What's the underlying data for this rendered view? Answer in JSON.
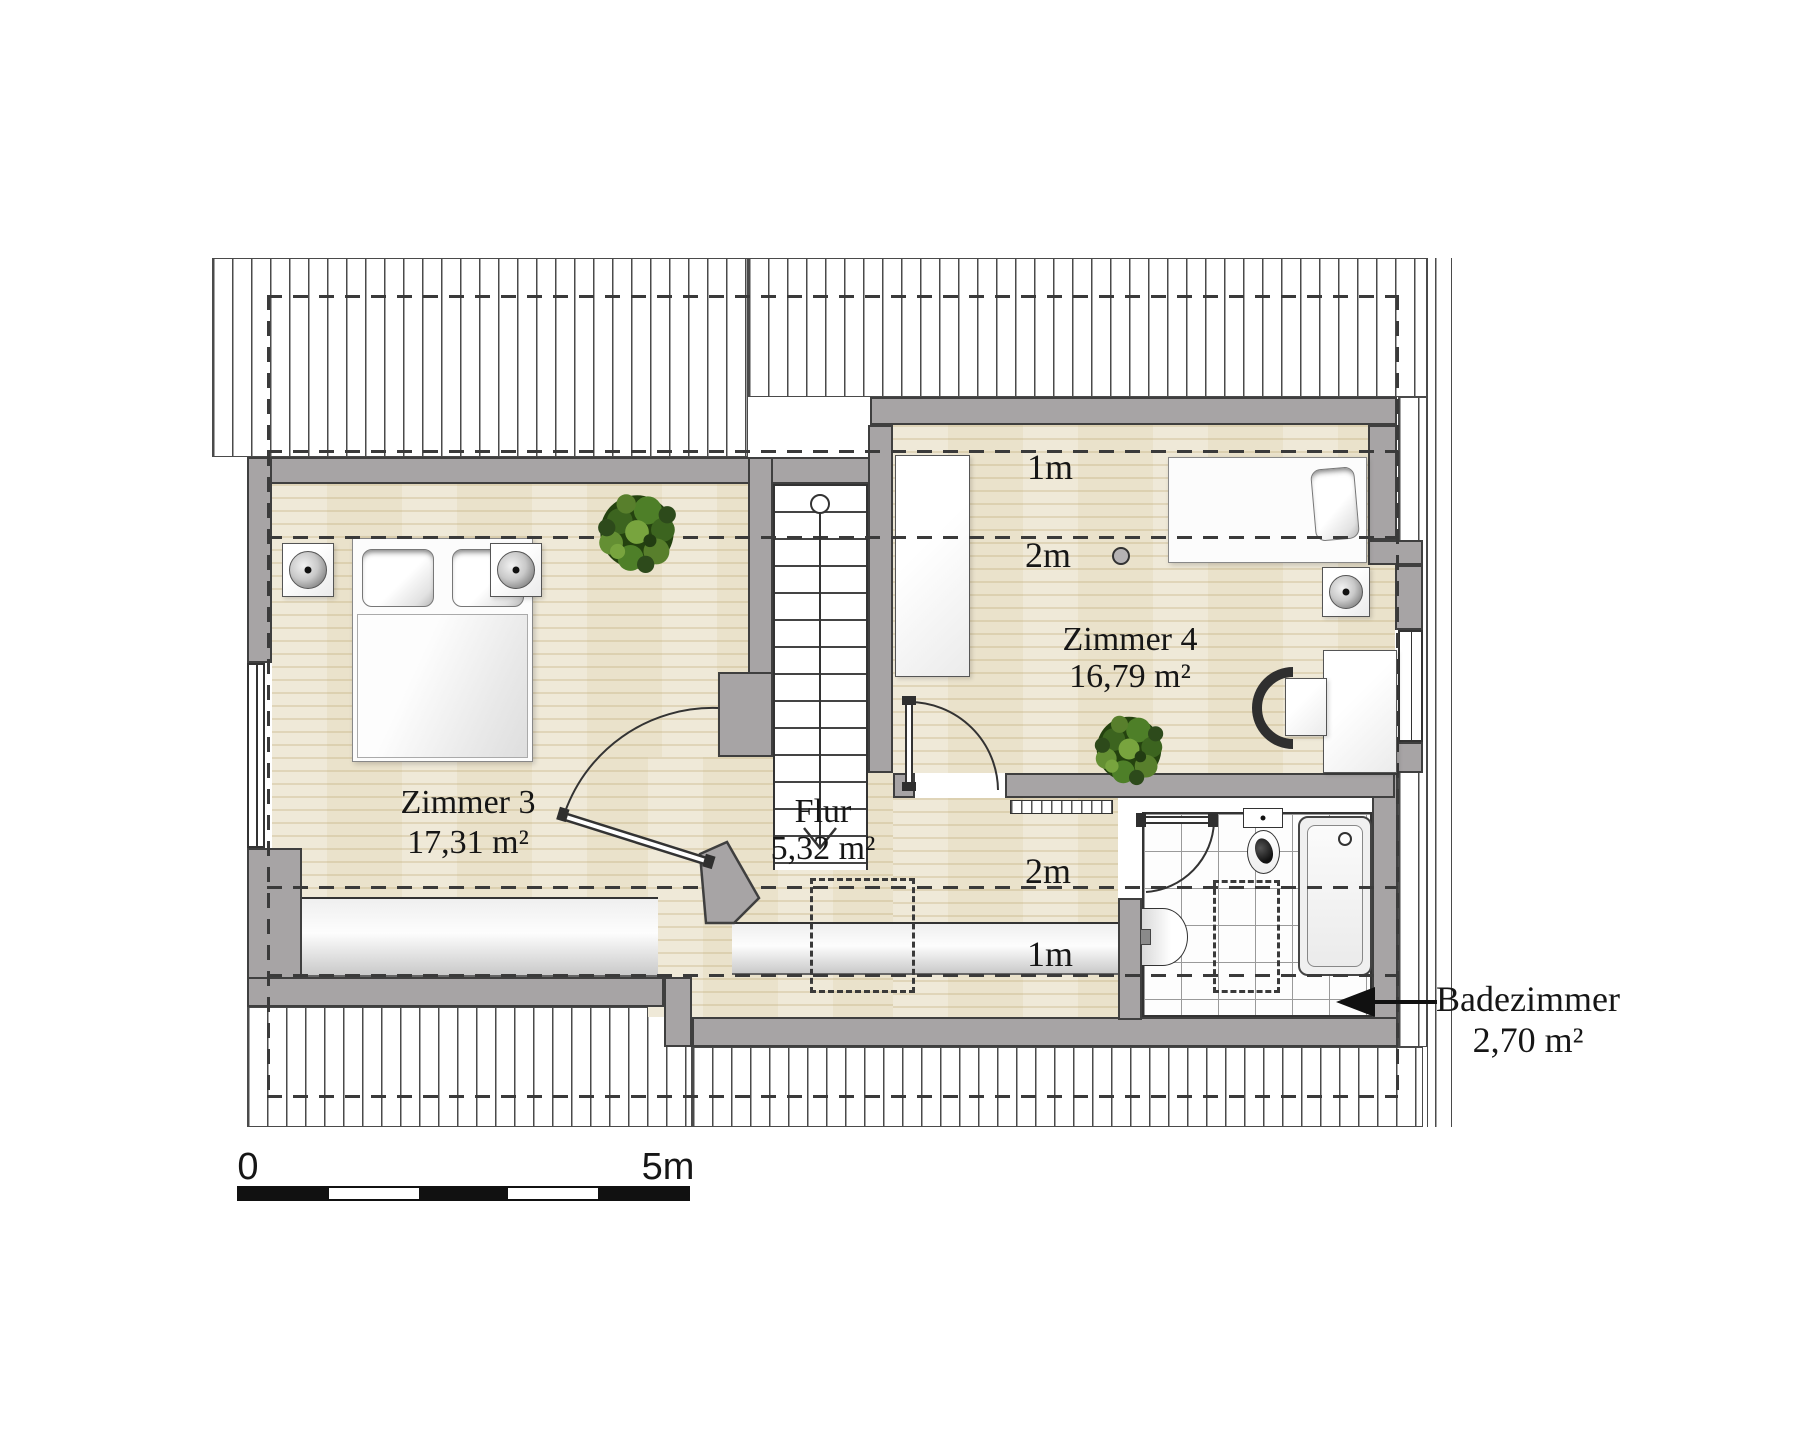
{
  "rooms": {
    "zimmer3": {
      "name": "Zimmer 3",
      "area": "17,31 m²"
    },
    "flur": {
      "name": "Flur",
      "area": "5,32 m²"
    },
    "zimmer4": {
      "name": "Zimmer 4",
      "area": "16,79 m²"
    },
    "badezimmer": {
      "name": "Badezimmer",
      "area": "2,70 m²"
    }
  },
  "height_markers": {
    "top_1m": "1m",
    "top_2m": "2m",
    "bottom_2m": "2m",
    "bottom_1m": "1m"
  },
  "scale_bar": {
    "start_label": "0",
    "end_label": "5m"
  },
  "colors": {
    "wall_gray": "#a7a4a5",
    "floor_beige": "#eae2cb",
    "outline": "#3a3a3a",
    "plant_green": "#3f6f22",
    "scale_black": "#111111"
  }
}
